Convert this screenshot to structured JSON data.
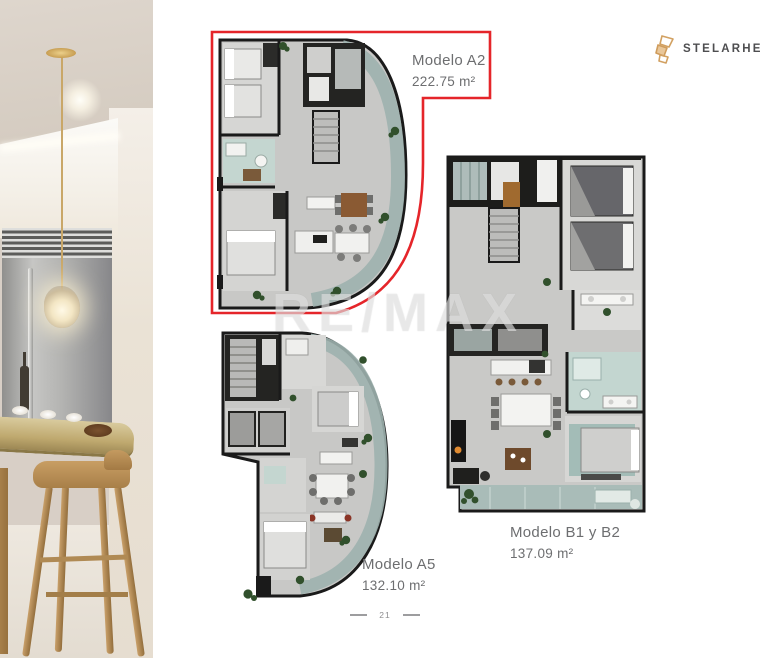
{
  "brand": {
    "name": "STELARHE"
  },
  "plans": [
    {
      "id": "a2",
      "label": "Modelo A2",
      "area": "222.75 m²",
      "highlighted": true
    },
    {
      "id": "a5",
      "label": "Modelo A5",
      "area": "132.10 m²",
      "highlighted": false
    },
    {
      "id": "b1b2",
      "label": "Modelo B1 y B2",
      "area": "137.09 m²",
      "highlighted": false
    }
  ],
  "watermark": {
    "text": "RE/MAX"
  },
  "page": {
    "number": "21"
  },
  "colors": {
    "highlight_red": "#e5252a",
    "brand_gold": "#d2a162",
    "label_gray": "#6d6e70"
  }
}
